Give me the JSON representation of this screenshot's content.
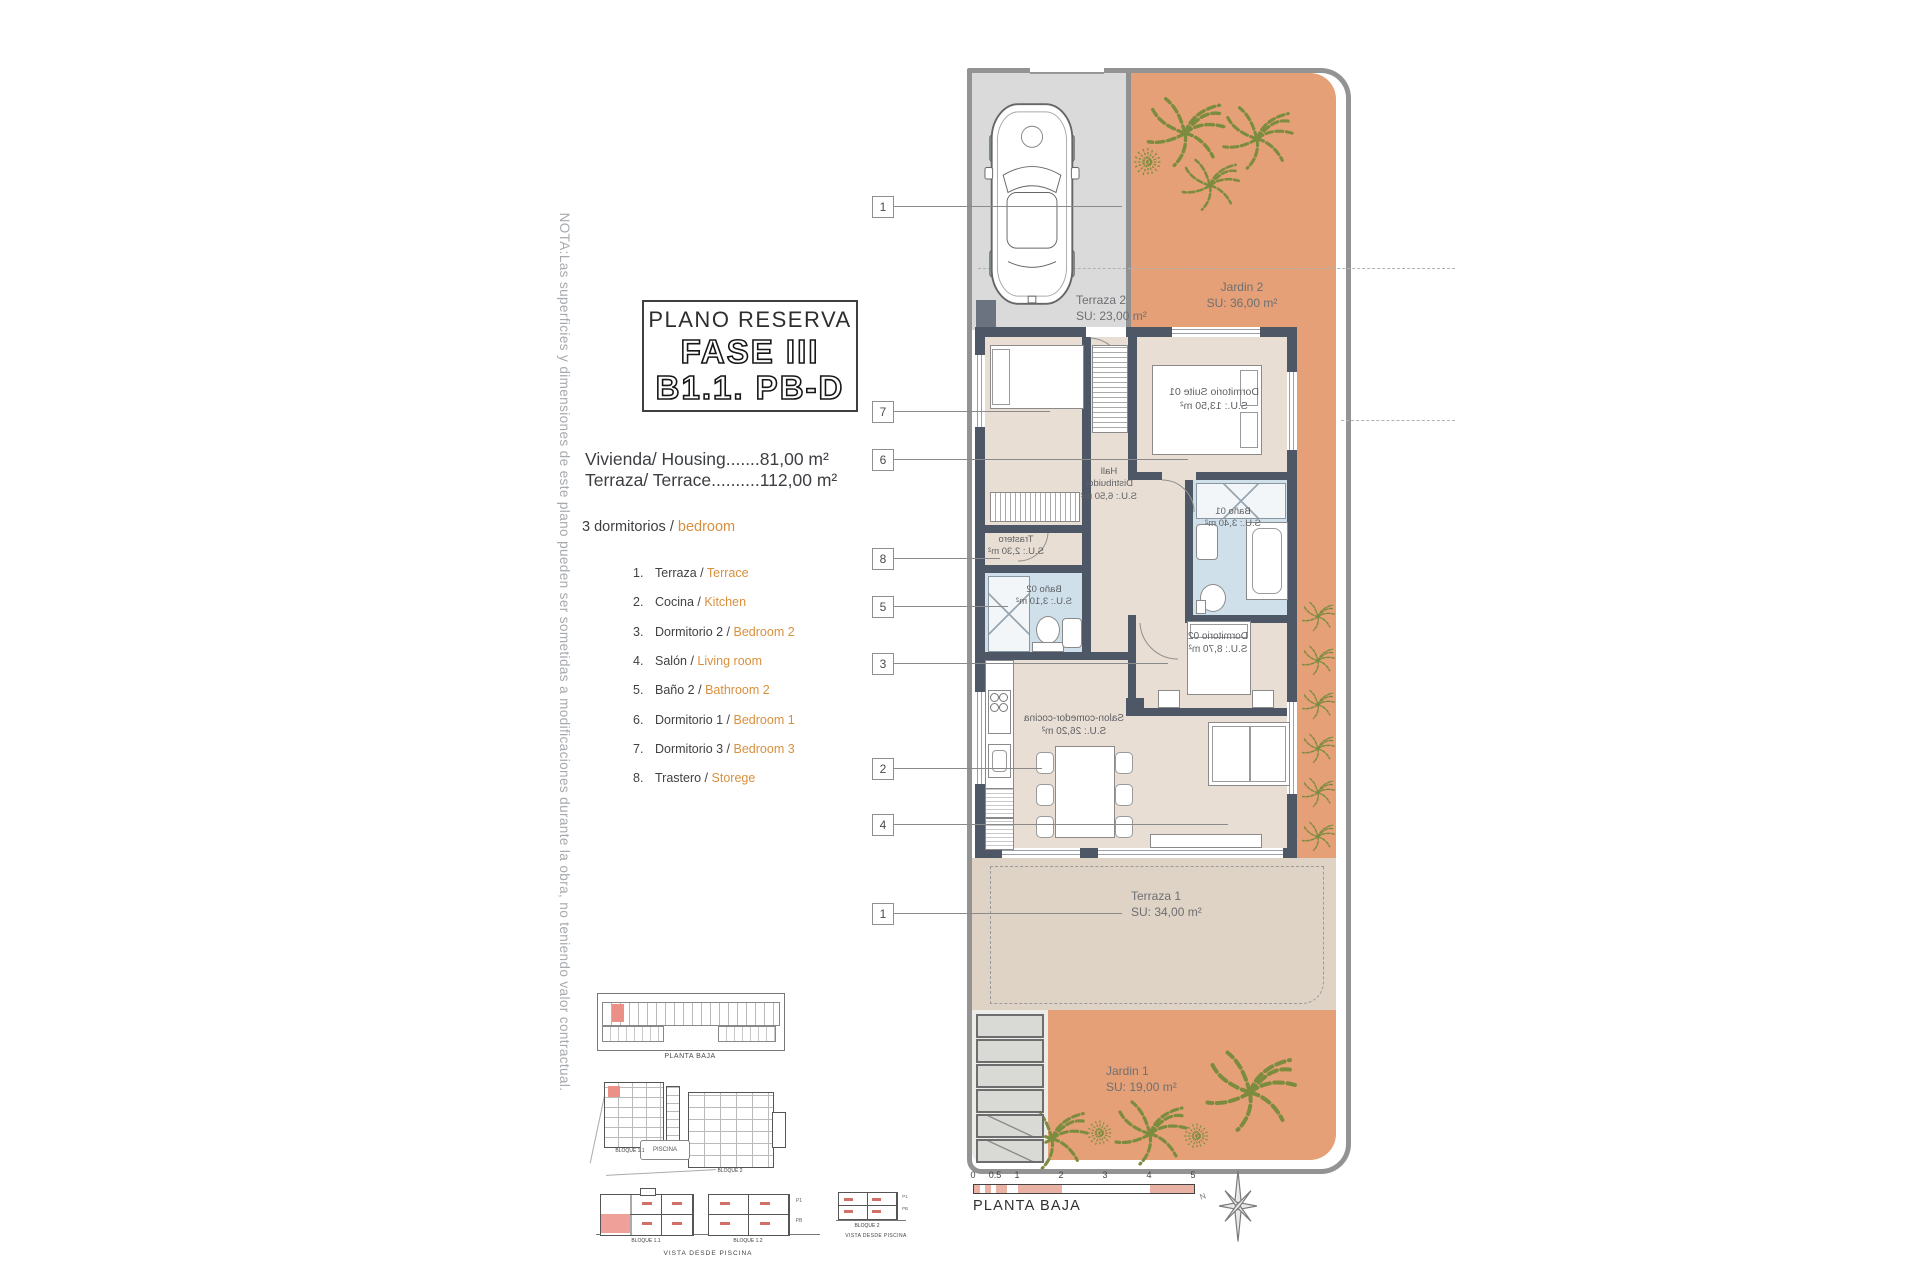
{
  "note": "NOTA:Las superficies y dimensiones de este plano pueden ser sometidas a modificaciones durante la obra, no teniendo valor contractual.",
  "title_block": {
    "line1": "PLANO RESERVA",
    "line2": "FASE III",
    "line3": "B1.1. PB-D"
  },
  "areas": {
    "housing": "Vivienda/ Housing.......81,00 m²",
    "terrace": "Terraza/ Terrace..........112,00 m²"
  },
  "bedrooms": {
    "es": "3 dormitorios /",
    "en": "bedroom"
  },
  "legend": {
    "items": [
      {
        "num": "1.",
        "es": "Terraza /",
        "en": "Terrace"
      },
      {
        "num": "2.",
        "es": "Cocina /",
        "en": "Kitchen"
      },
      {
        "num": "3.",
        "es": "Dormitorio 2 /",
        "en": "Bedroom 2"
      },
      {
        "num": "4.",
        "es": "Salón /",
        "en": "Living room"
      },
      {
        "num": "5.",
        "es": "Baño 2 /",
        "en": "Bathroom 2"
      },
      {
        "num": "6.",
        "es": "Dormitorio 1 /",
        "en": "Bedroom 1"
      },
      {
        "num": "7.",
        "es": "Dormitorio 3 /",
        "en": "Bedroom 3"
      },
      {
        "num": "8.",
        "es": "Trastero /",
        "en": "Storege"
      }
    ]
  },
  "plan": {
    "labels": {
      "terraza2": {
        "name": "Terraza 2",
        "area": "SU: 23,00 m²"
      },
      "jardin2": {
        "name": "Jardin 2",
        "area": "SU: 36,00 m²"
      },
      "suite": {
        "name": "Dormitorio Suite 01",
        "area": "S.U.: 13,50 m²"
      },
      "hall": {
        "l1": "Hall",
        "l2": "Distribuidor",
        "area": "S.U.: 6,50 m²"
      },
      "bano01": {
        "name": "Baño 01",
        "area": "S.U.: 3,40 m²"
      },
      "trastero": {
        "name": "Trastero",
        "area": "S.U.: 2,30 m²"
      },
      "bano02": {
        "name": "Baño 02",
        "area": "S.U.: 3,10 m²"
      },
      "dorm02": {
        "name": "Dormitorio 02",
        "area": "S.U.: 8,70 m²"
      },
      "salon": {
        "name": "Salon-comedor-cocina",
        "area": "S.U.: 26,20 m²"
      },
      "terraza1": {
        "name": "Terraza 1",
        "area": "SU: 34,00 m²"
      },
      "jardin1": {
        "name": "Jardin 1",
        "area": "SU: 19,00 m²"
      }
    },
    "callouts": [
      "1",
      "7",
      "6",
      "8",
      "5",
      "3",
      "2",
      "4",
      "1"
    ]
  },
  "scale_bar": {
    "ticks": [
      "0",
      "0.5",
      "1",
      "2",
      "3",
      "4",
      "5"
    ],
    "caption": "PLANTA BAJA",
    "north": "N"
  },
  "thumbnails": {
    "strip_caption": "PLANTA BAJA",
    "site": {
      "piscina": "PISCINA",
      "bloque11": "BLOQUE 1.1",
      "bloque2": "BLOQUE 2"
    },
    "elev1": {
      "b1": "BLOQUE 1.1",
      "b2": "BLOQUE 1.2",
      "view": "VISTA DESDE PISCINA",
      "p1": "P1",
      "pb": "PB"
    },
    "elev2": {
      "b": "BLOQUE 2",
      "view": "VISTA DESDE PISCINA",
      "p1": "P1",
      "pb": "PB"
    }
  },
  "colors": {
    "garden": "#E5A077",
    "floor": "#E9DED3",
    "terrace": "#DFD3C6",
    "driveway": "#DADADA",
    "wall": "#4D5766",
    "bath": "#CFE0EA",
    "accent_text": "#D8903E",
    "highlight_red": "#EC8F86",
    "plant_green": "#7C8C3F",
    "scalebar_pink": "#E9B2A5"
  }
}
